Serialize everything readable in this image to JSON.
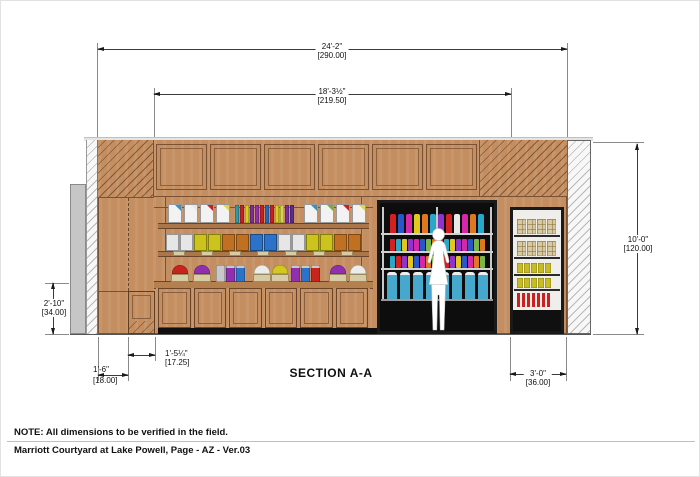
{
  "page": {
    "section_title": "SECTION A-A",
    "note": "NOTE: All dimensions to be verified in the field.",
    "project_line": "Marriott Courtyard at Lake Powell, Page - AZ - Ver.03"
  },
  "dimensions": {
    "overall_width": {
      "imperial": "24'-2\"",
      "metric": "[290.00]"
    },
    "millwork_width": {
      "imperial": "18'-3½\"",
      "metric": "[219.50]"
    },
    "overall_height": {
      "imperial": "10'-0\"",
      "metric": "[120.00]"
    },
    "counter_height": {
      "imperial": "2'-10\"",
      "metric": "[34.00]"
    },
    "left_return": {
      "imperial": "1'-6\"",
      "metric": "[18.00]"
    },
    "cabinet_width": {
      "imperial": "1'-5¼\"",
      "metric": "[17.25]"
    },
    "case_width": {
      "imperial": "3'-0\"",
      "metric": "[36.00]"
    }
  },
  "palette": {
    "wood": "#c48e60",
    "wood_line": "#7a5233",
    "case_black": "#151515",
    "counter_gray": "#c6c6c6",
    "silhouette": "#ffffff"
  },
  "fixtures": {
    "top_shelf_cards_left": [
      "#3b8fc4",
      "#e8e8e8",
      "#c8201e",
      "#ddd84a"
    ],
    "top_shelf_cards_right": [
      "#3b8fc4",
      "#6fae3f",
      "#c8201e",
      "#ddd84a"
    ],
    "top_shelf_books": [
      "#2e9aa8",
      "#c8201e",
      "#d8cc20",
      "#7a2d9c",
      "#9030b0",
      "#c8201e",
      "#2566c0",
      "#c8201e",
      "#d8cc20",
      "#d8d44a",
      "#7a2d9c",
      "#5a2d8c"
    ],
    "mid_shelf_boxes": [
      "#e6e6e6",
      "#ccc41c",
      "#c07020",
      "#2b72c8",
      "#e6e6e6",
      "#ccc41c",
      "#c07020"
    ],
    "basket_row": [
      {
        "type": "dome",
        "color": "#c8241e"
      },
      {
        "type": "dome",
        "color": "#9030b0"
      },
      {
        "type": "canisters",
        "colors": [
          "#c8c8c8",
          "#9030b0",
          "#2b72c8"
        ]
      },
      {
        "type": "dome",
        "color": "#ececec"
      },
      {
        "type": "dome",
        "color": "#d4c820"
      },
      {
        "type": "canisters",
        "colors": [
          "#9030b0",
          "#2b72c8",
          "#c8241e"
        ]
      },
      {
        "type": "dome",
        "color": "#9030b0"
      },
      {
        "type": "dome",
        "color": "#ececec"
      }
    ],
    "cooler_row1": [
      "#d42020",
      "#2858c8",
      "#d428a8",
      "#e0c820",
      "#e07820",
      "#28a8c8",
      "#9033cc",
      "#d42020",
      "#e8e8e8",
      "#d428a8",
      "#e07820",
      "#28a8c8"
    ],
    "cooler_row2": [
      "#d42020",
      "#28a8c8",
      "#e0c820",
      "#9033cc",
      "#d428a8",
      "#2858c8",
      "#7ab648",
      "#e07820",
      "#d42020",
      "#28a8c8",
      "#e0c820",
      "#9033cc",
      "#d428a8",
      "#2858c8",
      "#7ab648",
      "#e07820"
    ],
    "cooler_row3": [
      "#28a8c8",
      "#d42020",
      "#9033cc",
      "#e0c820",
      "#2858c8",
      "#d428a8",
      "#e07820",
      "#7ab648",
      "#28a8c8",
      "#d42020",
      "#9033cc",
      "#e0c820",
      "#2858c8",
      "#d428a8",
      "#e07820",
      "#7ab648"
    ],
    "cooler_jug_color": "#45a8cc",
    "snack_bag_count": 4,
    "candy_pack_count": 5,
    "stripe_box_count": 7
  }
}
